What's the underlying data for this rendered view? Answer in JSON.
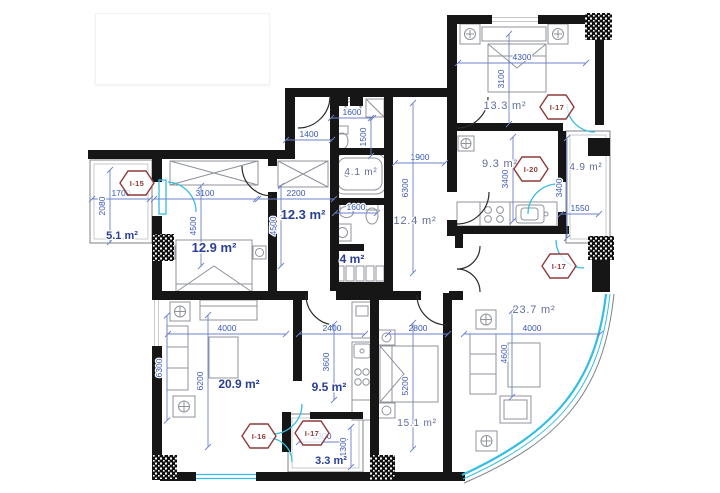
{
  "drawing": {
    "type": "apartment floor plan",
    "title_block_text": "",
    "colors": {
      "wall_black": "#161616",
      "dimension_blue": "#3a57b5",
      "room_label_blue": "#2a3f93",
      "room_label_gray_blue": "#606e93",
      "glass_cyan": "#35bde2",
      "unit_tag_red": "#8e3a3a",
      "furniture_gray": "#8f939b",
      "balcony_grid": "#c6cad2"
    },
    "rooms": [
      {
        "label": "5.1 m²",
        "x": 122,
        "y": 239,
        "style": "bold",
        "size": 11
      },
      {
        "label": "12.9 m²",
        "x": 214,
        "y": 252,
        "style": "bold",
        "size": 13
      },
      {
        "label": "12.3 m²",
        "x": 303,
        "y": 219,
        "style": "bold",
        "size": 13
      },
      {
        "label": "4.1 m²",
        "x": 361,
        "y": 175,
        "style": "light",
        "size": 10
      },
      {
        "label": "4 m²",
        "x": 352,
        "y": 263,
        "style": "bold",
        "size": 12
      },
      {
        "label": "12.4 m²",
        "x": 415,
        "y": 224,
        "style": "light",
        "size": 11
      },
      {
        "label": "13.3 m²",
        "x": 505,
        "y": 109,
        "style": "light",
        "size": 11
      },
      {
        "label": "9.3 m²",
        "x": 500,
        "y": 167,
        "style": "light",
        "size": 11
      },
      {
        "label": "4.9 m²",
        "x": 586,
        "y": 170,
        "style": "light",
        "size": 10
      },
      {
        "label": "23.7 m²",
        "x": 534,
        "y": 313,
        "style": "light",
        "size": 11
      },
      {
        "label": "15.1 m²",
        "x": 417,
        "y": 426,
        "style": "light",
        "size": 10
      },
      {
        "label": "20.9 m²",
        "x": 239,
        "y": 388,
        "style": "bold",
        "size": 12
      },
      {
        "label": "9.5 m²",
        "x": 329,
        "y": 391,
        "style": "bold",
        "size": 12
      },
      {
        "label": "3.3 m²",
        "x": 331,
        "y": 464,
        "style": "bold",
        "size": 11
      }
    ],
    "dimensions": [
      {
        "text": "1700",
        "x": 121,
        "y": 196,
        "o": "h",
        "len": 58
      },
      {
        "text": "2080",
        "x": 105,
        "y": 206,
        "o": "v",
        "len": 72
      },
      {
        "text": "3100",
        "x": 205,
        "y": 196,
        "o": "h",
        "len": 102
      },
      {
        "text": "2200",
        "x": 296,
        "y": 196,
        "o": "h",
        "len": 76
      },
      {
        "text": "1400",
        "x": 309,
        "y": 137,
        "o": "h",
        "len": 46
      },
      {
        "text": "4500",
        "x": 196,
        "y": 226,
        "o": "v",
        "len": 80
      },
      {
        "text": "4500",
        "x": 276,
        "y": 226,
        "o": "v",
        "len": 80
      },
      {
        "text": "1600",
        "x": 352,
        "y": 115,
        "o": "h",
        "len": 42
      },
      {
        "text": "1500",
        "x": 366,
        "y": 137,
        "o": "v",
        "len": 38
      },
      {
        "text": "1600",
        "x": 356,
        "y": 210,
        "o": "h",
        "len": 42
      },
      {
        "text": "1900",
        "x": 420,
        "y": 160,
        "o": "h",
        "len": 50
      },
      {
        "text": "6300",
        "x": 408,
        "y": 188,
        "o": "v",
        "len": 170
      },
      {
        "text": "4300",
        "x": 522,
        "y": 60,
        "o": "h",
        "len": 128
      },
      {
        "text": "3100",
        "x": 504,
        "y": 79,
        "o": "v",
        "len": 90
      },
      {
        "text": "3400",
        "x": 508,
        "y": 179,
        "o": "v",
        "len": 84
      },
      {
        "text": "3400",
        "x": 562,
        "y": 188,
        "o": "v",
        "len": 100
      },
      {
        "text": "1550",
        "x": 580,
        "y": 211,
        "o": "h",
        "len": 38
      },
      {
        "text": "4000",
        "x": 227,
        "y": 331,
        "o": "h",
        "len": 118
      },
      {
        "text": "2400",
        "x": 332,
        "y": 331,
        "o": "h",
        "len": 66
      },
      {
        "text": "2800",
        "x": 418,
        "y": 331,
        "o": "h",
        "len": 60
      },
      {
        "text": "4000",
        "x": 532,
        "y": 331,
        "o": "h",
        "len": 136
      },
      {
        "text": "6300",
        "x": 162,
        "y": 368,
        "o": "v",
        "len": 105
      },
      {
        "text": "6200",
        "x": 203,
        "y": 381,
        "o": "v",
        "len": 132
      },
      {
        "text": "3600",
        "x": 329,
        "y": 362,
        "o": "v",
        "len": 76
      },
      {
        "text": "5200",
        "x": 408,
        "y": 386,
        "o": "v",
        "len": 126
      },
      {
        "text": "4600",
        "x": 507,
        "y": 354,
        "o": "v",
        "len": 86
      },
      {
        "text": "2300",
        "x": 322,
        "y": 439,
        "o": "h",
        "len": 46
      },
      {
        "text": "1300",
        "x": 346,
        "y": 447,
        "o": "v",
        "len": 40
      }
    ],
    "unit_tags": [
      {
        "label": "I-15",
        "x": 137,
        "y": 183
      },
      {
        "label": "I-17",
        "x": 557,
        "y": 107
      },
      {
        "label": "I-20",
        "x": 531,
        "y": 169
      },
      {
        "label": "I-17",
        "x": 559,
        "y": 266
      },
      {
        "label": "I-16",
        "x": 259,
        "y": 436
      },
      {
        "label": "I-17",
        "x": 312,
        "y": 433
      }
    ]
  }
}
